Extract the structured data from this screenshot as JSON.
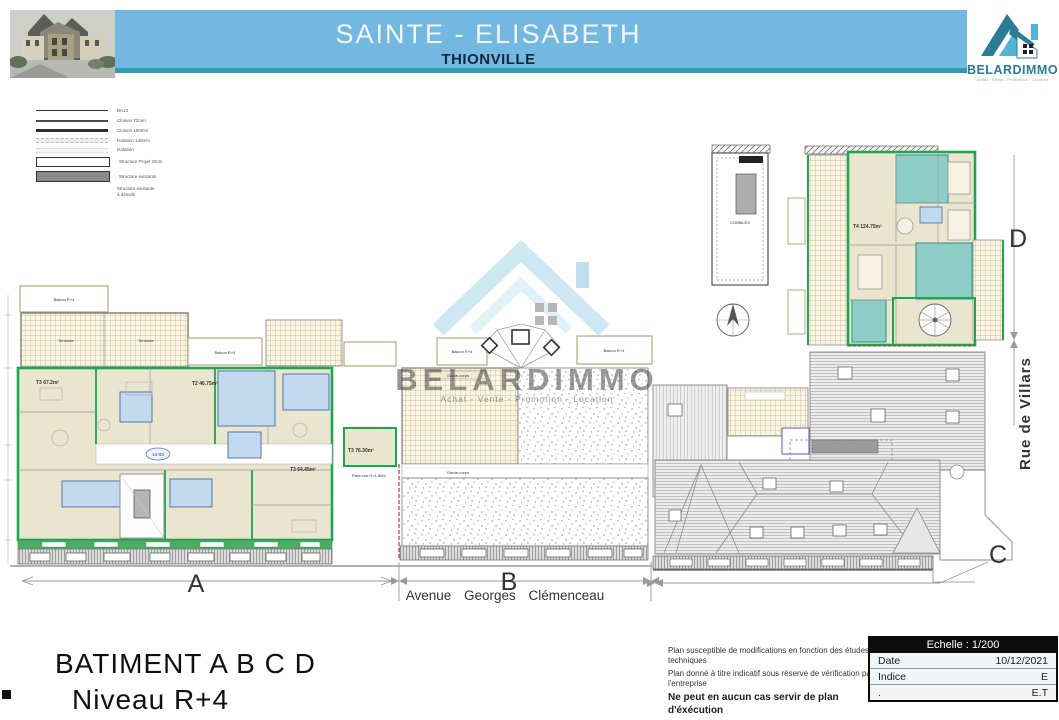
{
  "header": {
    "title": "SAINTE - ELISABETH",
    "subtitle": "THIONVILLE",
    "brand": {
      "name": "BELARDIMMO",
      "tagline": "Achat - Vente - Promotion - Location"
    }
  },
  "legend": {
    "items": [
      {
        "label": "BA13"
      },
      {
        "label": "Cloison 72mm"
      },
      {
        "label": "Cloison 100mm"
      },
      {
        "label": "Isolation 140mm"
      },
      {
        "label": "Isolation"
      },
      {
        "label": "Structure Projet 20cm"
      },
      {
        "label": "Structure existante"
      },
      {
        "label": "Structure existante\nà démolir"
      }
    ]
  },
  "watermark": {
    "name": "BELARDIMMO",
    "tagline": "Achat - Vente - Promotion - Location"
  },
  "plan": {
    "sections": {
      "a": "A",
      "b": "B",
      "c": "C",
      "d": "D"
    },
    "streets": {
      "avenue": "Avenue Georges Clémenceau",
      "rue": "Rue de Villars"
    },
    "apartments": {
      "a1": "T3 67.2m²",
      "a2": "T2 46.75m²",
      "a3": "T3 64.45m²",
      "a4": "T3 76.30m²",
      "d1": "T4 124.75m²"
    },
    "annotations": {
      "terrasse": "Terrasse",
      "balcon": "Balcon R+4",
      "garde_corps": "Garde-corps",
      "pare_vue": "Pare-vue H=1.80m",
      "combles": "COMBLES",
      "corridor_tag": "14-03"
    }
  },
  "footer": {
    "building_title": "BATIMENT A B C D",
    "level": "Niveau R+4",
    "notes": [
      "Plan susceptible de modifications en fonction des études techniques",
      "Plan donné à titre indicatif sous réserve de vérification par l'entreprise",
      "Ne peut en aucun cas servir de plan d'éxécution"
    ],
    "info_table": {
      "header": "Echelle : 1/200",
      "rows": [
        {
          "label": "Date",
          "value": "10/12/2021"
        },
        {
          "label": "Indice",
          "value": "E"
        },
        {
          "label": ".",
          "value": "E.T"
        }
      ]
    }
  },
  "colors": {
    "header_blue": "#72b8e1",
    "header_teal": "#2d9cb0",
    "brand_teal": "#2a7d94",
    "plan_green": "#1ca64f",
    "room_beige": "#eae5cf",
    "bath_blue": "#c3d9ed",
    "bath_teal": "#8ecdc6",
    "watermark_blue": "#9fd2e8",
    "red_dash": "#cc3333"
  }
}
